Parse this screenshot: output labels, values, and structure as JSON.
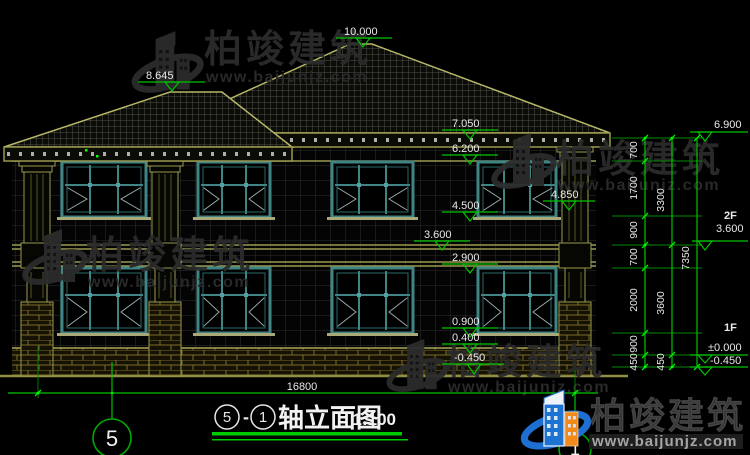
{
  "brand": {
    "name": "柏竣建筑",
    "url": "www.baijunjz.com"
  },
  "title": {
    "axis_a": "5",
    "separator": "-",
    "axis_b": "1",
    "text": "轴立面图",
    "scale": "1:100"
  },
  "axis_bubbles": {
    "left": "5",
    "right": "1"
  },
  "levels": {
    "main_ridge": "10.000",
    "wing_ridge": "8.645",
    "eave_top": "7.050",
    "cornice_bottom": "6.200",
    "pillar_cap": "4.850",
    "window2_sill": "4.500",
    "floor2": "3.600",
    "window1_head": "2.900",
    "window1_sill": "0.900",
    "plinth_top": "0.400",
    "ground": "-0.450"
  },
  "right_panel": {
    "eave_level": "6.900",
    "floor2_tag": "2F",
    "floor2_level": "3.600",
    "floor1_tag": "1F",
    "floor1_level": "±0.000",
    "basement_level": "-0.450",
    "chain_inner": [
      "700",
      "1700",
      "900",
      "700",
      "2000",
      "900",
      "450"
    ],
    "chain_mid": [
      "3300",
      "3600",
      "450"
    ],
    "chain_total": "7350"
  },
  "dimensions": {
    "total_width": "16800"
  },
  "colors": {
    "line_green": "#00c400",
    "annotation_white": "#e8e8e8",
    "cad_olive": "#a8a858",
    "window_teal": "#3f8888",
    "logo_blue": "#1d6fd1",
    "logo_orange": "#f08a1d"
  }
}
